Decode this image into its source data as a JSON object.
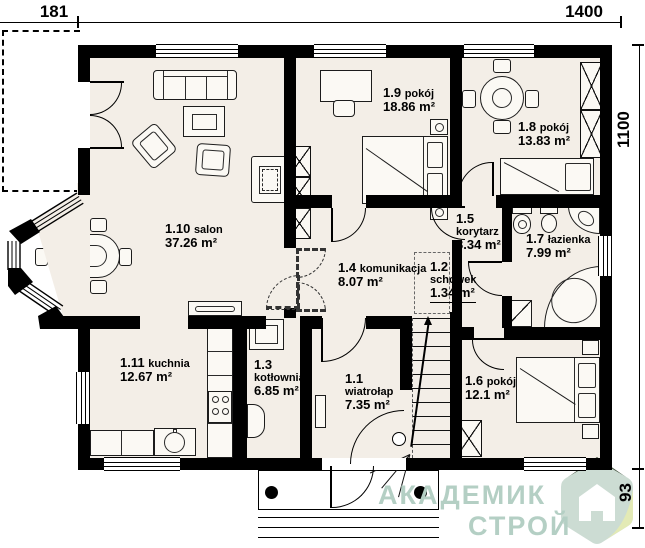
{
  "plan": {
    "title": "floor-plan",
    "dimensions": {
      "top_left": "181",
      "top_right": "1400",
      "right": "1100",
      "bottom_right": "93"
    },
    "rooms": [
      {
        "id": "1.1",
        "name": "wiatrołap",
        "area": "7.35 m²"
      },
      {
        "id": "1.2",
        "name": "schowek",
        "area": "1.34 m²"
      },
      {
        "id": "1.3",
        "name": "kotłownia",
        "area": "6.85 m²"
      },
      {
        "id": "1.4",
        "name": "komunikacja",
        "area": "8.07 m²"
      },
      {
        "id": "1.5",
        "name": "korytarz",
        "area": "3.34 m²"
      },
      {
        "id": "1.6",
        "name": "pokój",
        "area": "12.1 m²"
      },
      {
        "id": "1.7",
        "name": "łazienka",
        "area": "7.99 m²"
      },
      {
        "id": "1.8",
        "name": "pokój",
        "area": "13.83 m²"
      },
      {
        "id": "1.9",
        "name": "pokój",
        "area": "18.86 m²"
      },
      {
        "id": "1.10",
        "name": "salon",
        "area": "37.26 m²"
      },
      {
        "id": "1.11",
        "name": "kuchnia",
        "area": "12.67 m²"
      }
    ],
    "logo": {
      "line1": "АКАДЕМИК",
      "line2": "СТРОЙ"
    },
    "colors": {
      "floor": "#f3eee7",
      "wall": "#000000",
      "logo_text": "#b4cfc4",
      "badge_main": "#ccdcd3",
      "badge_fold": "#e3eab5",
      "badge_dark": "#42523e"
    }
  }
}
